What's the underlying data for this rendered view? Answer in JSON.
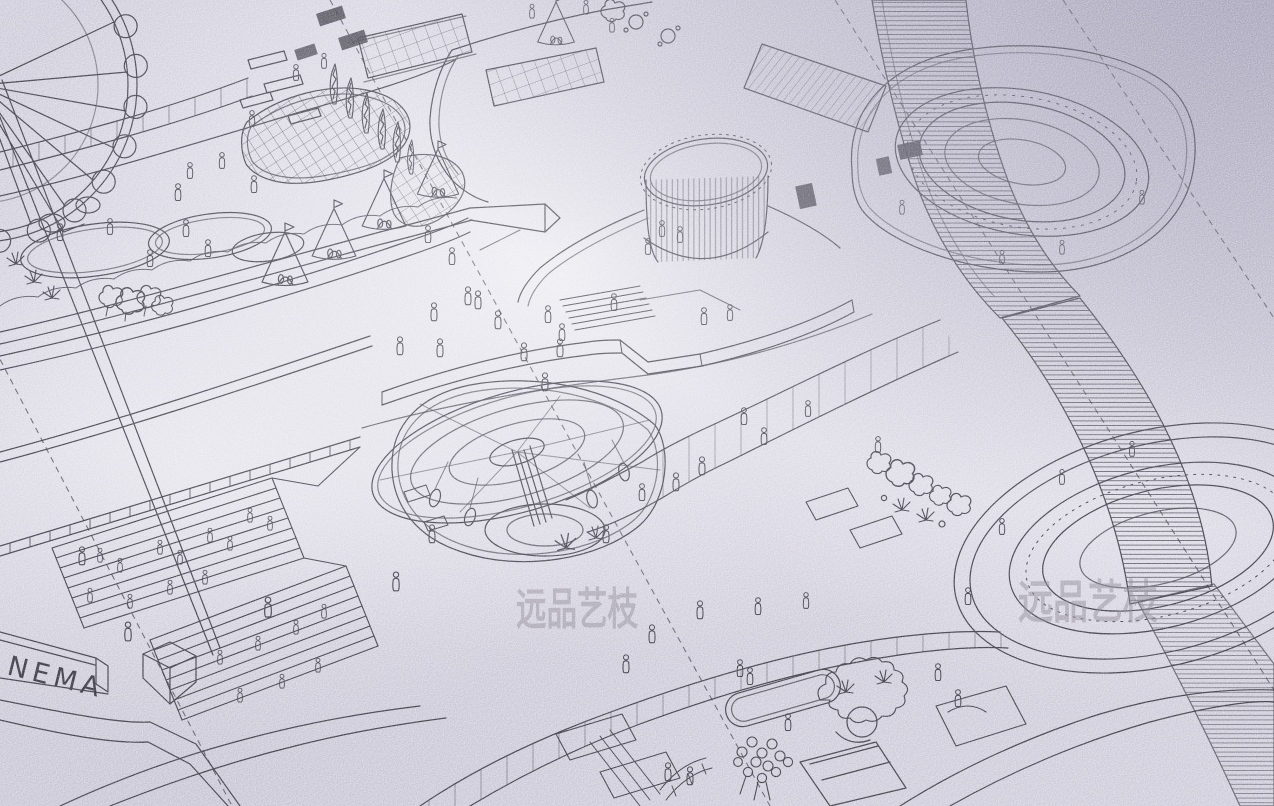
{
  "scene": {
    "type": "photographed hand-drawn isometric masterplan illustration of an amusement / leisure park",
    "sign_text": "NEMA",
    "sign_note": "right part of the word CINEMA, cropped by the image edge",
    "watermark_text": "远品艺枝",
    "watermark_count": 2,
    "colors": {
      "paper_base": "#cdcad9",
      "paper_shadow": "#a9a6bb",
      "paper_highlight": "#f4f3f7",
      "ink": "#35343f",
      "watermark": "#8b8896"
    },
    "features": [
      "ferris wheel",
      "lattice shell canopy",
      "teepee tents",
      "ponds",
      "amphitheater steps with spectators",
      "cinema building sign",
      "swing carousel",
      "rotunda drum hall",
      "oval arena plaza",
      "hatched pedestrian bridge",
      "ring plaza",
      "garden walkways",
      "oval pool",
      "rock garden",
      "crowd of visitors",
      "dashed setting-out guide lines"
    ]
  }
}
